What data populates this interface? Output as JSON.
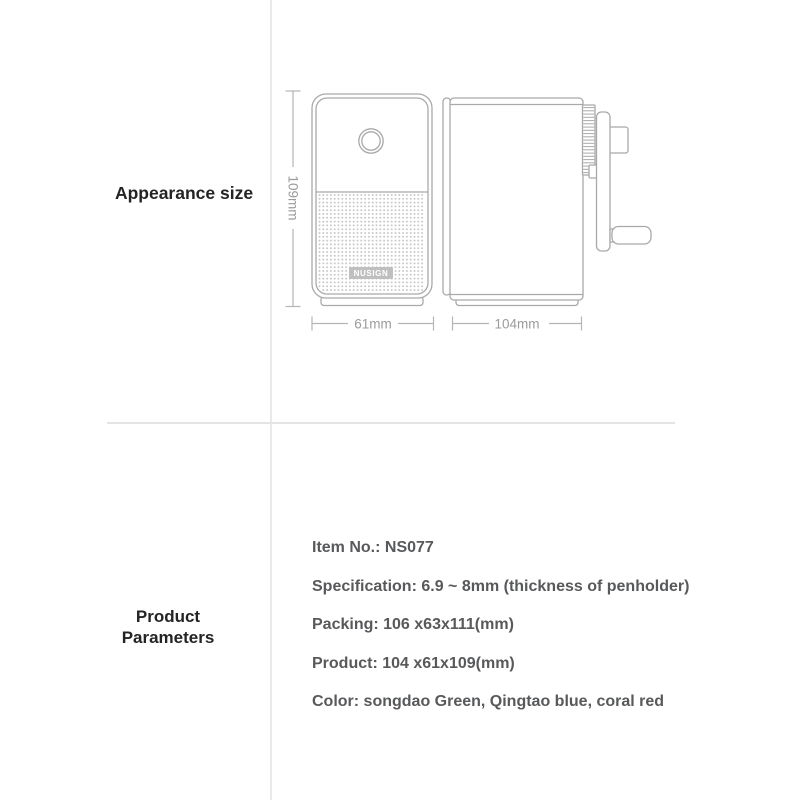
{
  "appearance": {
    "label": "Appearance size",
    "front_view": {
      "height_label": "109mm",
      "width_label": "61mm",
      "logo": "NUSIGN"
    },
    "side_view": {
      "depth_label": "104mm"
    }
  },
  "parameters": {
    "label_line1": "Product",
    "label_line2": "Parameters",
    "rows": [
      "Item No.: NS077",
      "Specification: 6.9 ~ 8mm (thickness of penholder)",
      "Packing: 106 x63x111(mm)",
      "Product: 104 x61x109(mm)",
      "Color: songdao Green, Qingtao blue, coral red"
    ]
  },
  "colors": {
    "heading_text": "#242424",
    "parameter_text": "#58595b",
    "line_art": "#a9a9a9",
    "dimension_text": "#9b9b9b",
    "divider": "#e7e7e7",
    "halftone_dots": "#c9c9c9",
    "logo_fill": "#bfbfbf",
    "logo_text": "#ffffff"
  }
}
